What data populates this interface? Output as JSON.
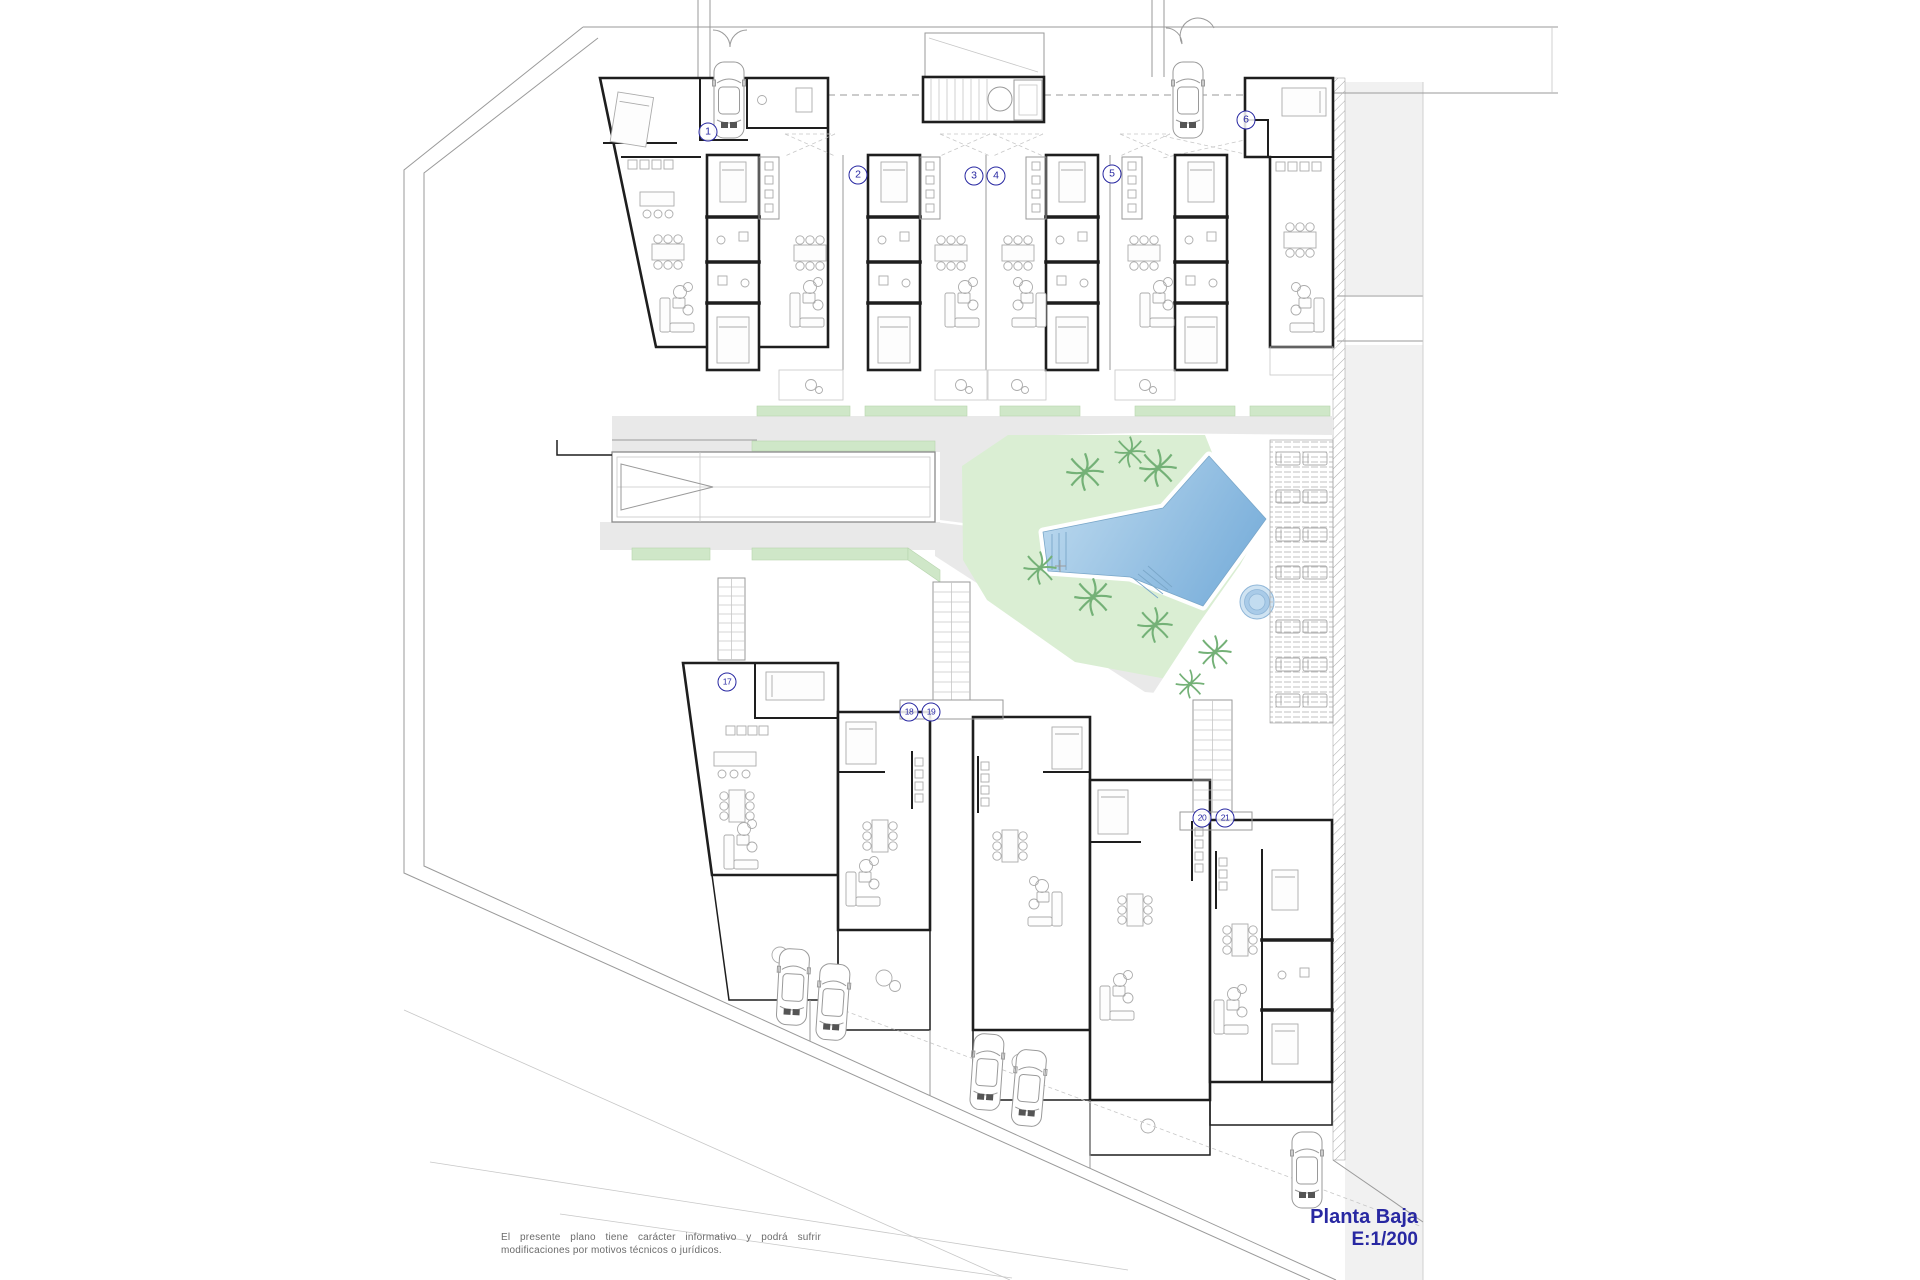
{
  "plan": {
    "title": "Planta Baja",
    "scale": "E:1/200",
    "disclaimer": "El presente plano tiene carácter informativo y podrá sufrir modificaciones por motivos técnicos o jurídicos.",
    "unit_labels": [
      {
        "label": "1",
        "x": 708,
        "y": 132
      },
      {
        "label": "2",
        "x": 858,
        "y": 175
      },
      {
        "label": "3",
        "x": 974,
        "y": 176
      },
      {
        "label": "4",
        "x": 996,
        "y": 176
      },
      {
        "label": "5",
        "x": 1112,
        "y": 174
      },
      {
        "label": "6",
        "x": 1246,
        "y": 120
      },
      {
        "label": "17",
        "x": 727,
        "y": 682
      },
      {
        "label": "18",
        "x": 909,
        "y": 712
      },
      {
        "label": "19",
        "x": 931,
        "y": 712
      },
      {
        "label": "20",
        "x": 1202,
        "y": 818
      },
      {
        "label": "21",
        "x": 1225,
        "y": 818
      }
    ],
    "palette": {
      "wall": "#1e1e1e",
      "line": "#9a9a9a",
      "furniture": "#ababab",
      "road": "#e9e9e9",
      "neighbor": "#f1f1f1",
      "green": "#daeed3",
      "green_strip": "#cfe7c8",
      "tree": "#74b177",
      "pool_light": "#c2ddf0",
      "pool_dark": "#7fb2dc",
      "pool_edge": "#7aa7c9",
      "navy": "#2828a2",
      "text_gray": "#6b6b6b"
    }
  }
}
